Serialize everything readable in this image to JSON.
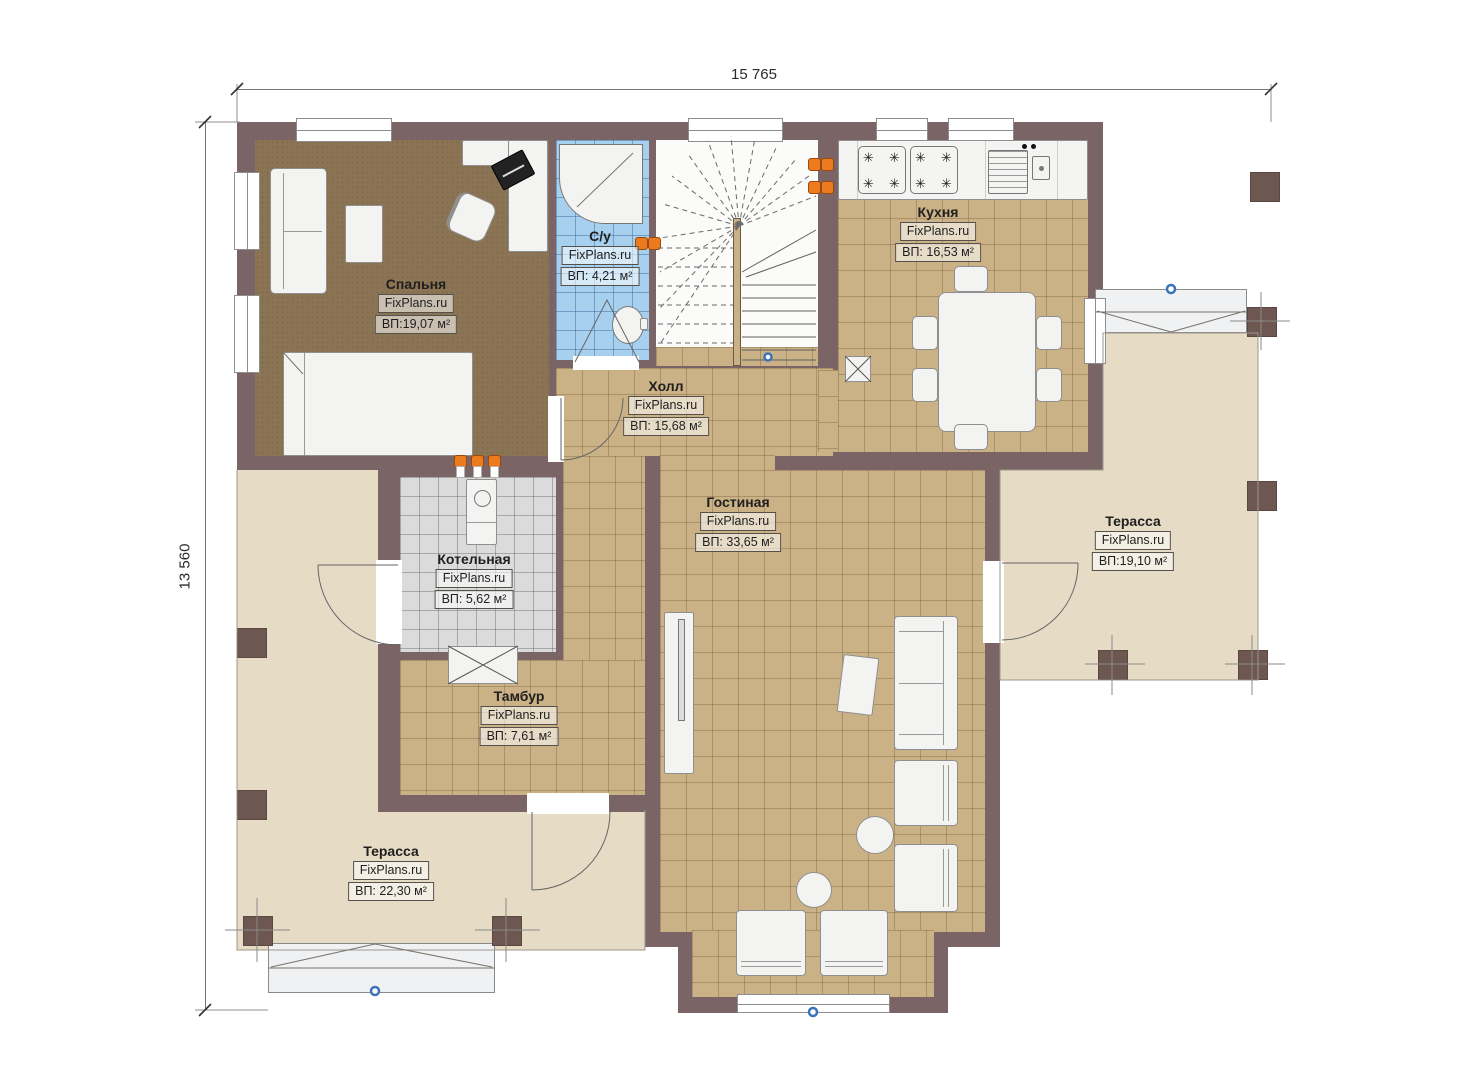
{
  "plan": {
    "width_dimension": "15 765",
    "height_dimension": "13 560"
  },
  "watermark": "FixPlans.ru",
  "rooms": [
    {
      "name": "Спальня",
      "area": "ВП:19,07 м²"
    },
    {
      "name": "С/у",
      "area": "ВП: 4,21 м²"
    },
    {
      "name": "Кухня",
      "area": "ВП: 16,53 м²"
    },
    {
      "name": "Холл",
      "area": "ВП: 15,68 м²"
    },
    {
      "name": "Гостиная",
      "area": "ВП: 33,65 м²"
    },
    {
      "name": "Котельная",
      "area": "ВП: 5,62 м²"
    },
    {
      "name": "Тамбур",
      "area": "ВП: 7,61 м²"
    },
    {
      "name": "Терасса",
      "area": "ВП:19,10 м²"
    },
    {
      "name": "Терасса",
      "area": "ВП: 22,30 м²"
    }
  ],
  "icons": {
    "burner": "✳"
  },
  "colors": {
    "wall": "#7A6466",
    "wood_floor": "#8B7453",
    "tile_floor": "#CBB186",
    "terrace_floor": "#E6DBC5",
    "bath_tile": "#A6D0EE",
    "boiler_tile": "#DBDBDB",
    "accent_orange": "#EC7A1E",
    "marker_blue": "#3B72BC"
  }
}
